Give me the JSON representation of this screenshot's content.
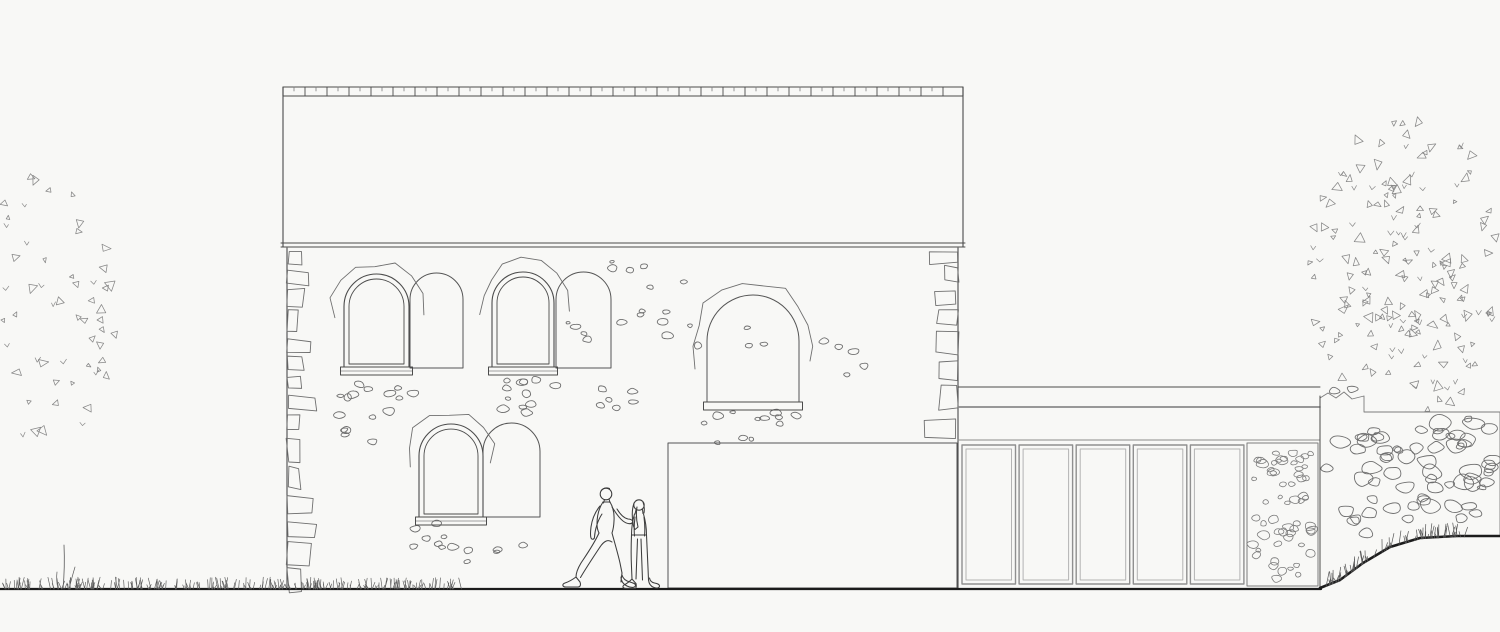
{
  "canvas": {
    "width": 1500,
    "height": 632,
    "background": "#f8f8f6",
    "ink": "#4b4b4b",
    "ink_light": "#8b8b8b",
    "ink_soft": "#6f6f6f",
    "ink_dark": "#1c1c1c"
  },
  "seed": 1337,
  "ground": {
    "y": 589,
    "x_start": 0,
    "x_end": 1321,
    "thickness": 2.2
  },
  "house": {
    "wall": {
      "x1": 287,
      "x2": 958,
      "top": 248,
      "bottom": 589
    },
    "roof": {
      "x1": 283,
      "x2": 963,
      "top": 87,
      "ridge_bottom": 96,
      "eave1": 243,
      "eave2": 247,
      "tile_w": 22,
      "row_h": 11
    },
    "windows": [
      {
        "id": "window-upper-left",
        "x": 344,
        "w": 65,
        "top": 274,
        "bottom": 367
      },
      {
        "id": "window-upper-mid",
        "x": 492,
        "w": 62,
        "top": 272,
        "bottom": 367
      },
      {
        "id": "window-lower-left",
        "x": 419,
        "w": 64,
        "top": 424,
        "bottom": 517
      }
    ],
    "arch_infills": [
      {
        "id": "infill-upper-left",
        "x": 410,
        "w": 53,
        "top": 273,
        "bottom": 368,
        "sill": false,
        "surround": false
      },
      {
        "id": "infill-upper-mid",
        "x": 556,
        "w": 55,
        "top": 272,
        "bottom": 368,
        "sill": false,
        "surround": false
      },
      {
        "id": "infill-central",
        "x": 707,
        "w": 92,
        "top": 295,
        "bottom": 402,
        "sill": true,
        "surround": true
      },
      {
        "id": "infill-lower",
        "x": 483,
        "w": 57,
        "top": 423,
        "bottom": 517,
        "sill": false,
        "surround": false
      }
    ],
    "demolition_panel": {
      "x": 668,
      "y": 443,
      "w": 289,
      "h": 145
    },
    "quoins_left": {
      "x": 287,
      "top": 251,
      "bottom": 585,
      "min_w": 10,
      "max_w": 30
    },
    "quoins_right": {
      "x": 958,
      "top": 251,
      "bottom": 437,
      "min_w": 12,
      "max_w": 34
    },
    "stone_clusters": [
      {
        "cx": 380,
        "cy": 420,
        "rx": 45,
        "ry": 38,
        "n": 16,
        "smin": 5,
        "smax": 12
      },
      {
        "cx": 523,
        "cy": 392,
        "rx": 38,
        "ry": 22,
        "n": 12,
        "smin": 5,
        "smax": 11
      },
      {
        "cx": 650,
        "cy": 273,
        "rx": 40,
        "ry": 18,
        "n": 6,
        "smin": 5,
        "smax": 11
      },
      {
        "cx": 655,
        "cy": 330,
        "rx": 45,
        "ry": 20,
        "n": 8,
        "smin": 5,
        "smax": 11
      },
      {
        "cx": 580,
        "cy": 335,
        "rx": 22,
        "ry": 13,
        "n": 4,
        "smin": 4,
        "smax": 9
      },
      {
        "cx": 848,
        "cy": 358,
        "rx": 28,
        "ry": 18,
        "n": 5,
        "smin": 6,
        "smax": 12
      },
      {
        "cx": 752,
        "cy": 337,
        "rx": 18,
        "ry": 11,
        "n": 3,
        "smin": 5,
        "smax": 9
      },
      {
        "cx": 625,
        "cy": 406,
        "rx": 25,
        "ry": 17,
        "n": 6,
        "smin": 5,
        "smax": 10
      },
      {
        "cx": 750,
        "cy": 426,
        "rx": 48,
        "ry": 18,
        "n": 12,
        "smin": 5,
        "smax": 11
      },
      {
        "cx": 445,
        "cy": 542,
        "rx": 33,
        "ry": 22,
        "n": 10,
        "smin": 5,
        "smax": 11
      },
      {
        "cx": 508,
        "cy": 552,
        "rx": 18,
        "ry": 12,
        "n": 3,
        "smin": 5,
        "smax": 9
      }
    ]
  },
  "extension": {
    "fascia": {
      "x1": 958,
      "x2": 1320,
      "top": 387,
      "mid": 407,
      "bottom": 440
    },
    "glazing": {
      "x": 962,
      "top": 445,
      "bottom": 584,
      "panel_w": 53.5,
      "gap": 3.6,
      "count": 5
    },
    "pier": {
      "x1": 1247,
      "x2": 1318,
      "top": 443,
      "bottom": 586,
      "n_stones": 58
    }
  },
  "bank": {
    "left_x": 1320,
    "jag_top": 396,
    "step_x": 1364,
    "top_y": 412,
    "right_x": 1500,
    "curve": [
      [
        1320,
        588
      ],
      [
        1340,
        580
      ],
      [
        1363,
        563
      ],
      [
        1390,
        547
      ],
      [
        1420,
        538
      ],
      [
        1457,
        536
      ],
      [
        1500,
        536
      ]
    ],
    "n_stones": 66,
    "grass_count": 70
  },
  "trees": {
    "left": {
      "cx": 45,
      "cy": 312,
      "rx": 72,
      "ry": 138,
      "count": 58
    },
    "right": {
      "cx": 1408,
      "cy": 268,
      "rx": 100,
      "ry": 150,
      "count": 178
    }
  },
  "grass_left": {
    "x1": 2,
    "x2": 468,
    "count": 260,
    "tall_x": 63,
    "tall_h": 44
  },
  "figures": [
    {
      "id": "walking-man",
      "x": 606,
      "y": 494
    },
    {
      "id": "walking-woman",
      "x": 639,
      "y": 505
    }
  ]
}
